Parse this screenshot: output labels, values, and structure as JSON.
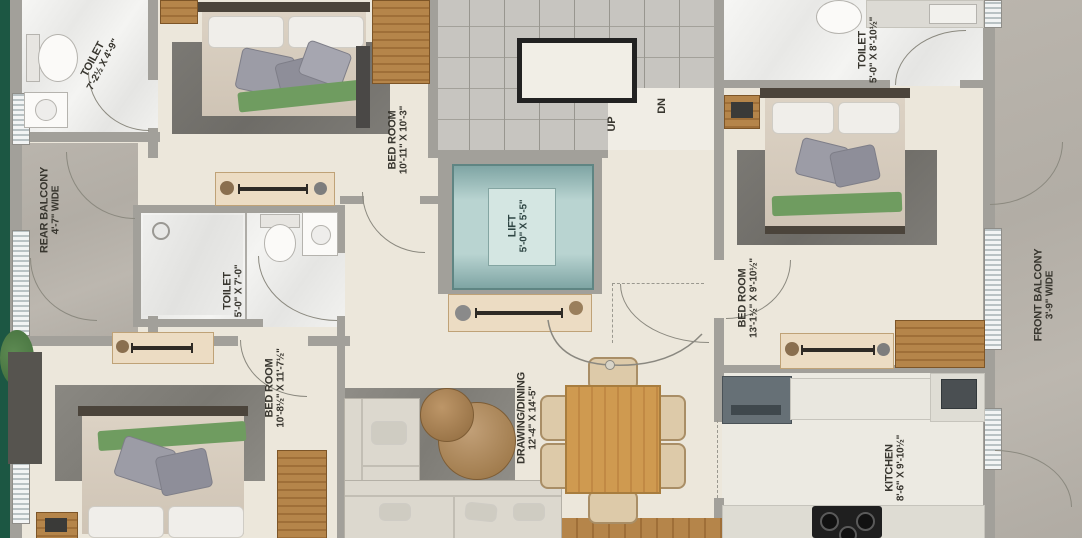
{
  "rooms": {
    "toilet_tl": {
      "name": "TOILET",
      "dims": "7'-2½ X 4'-9\""
    },
    "rear_balcony": {
      "name": "REAR BALCONY",
      "dims": "4'-7\" WIDE"
    },
    "bedroom_top": {
      "name": "BED ROOM",
      "dims": "10'-11\" X 10'-3\""
    },
    "lift": {
      "name": "LIFT",
      "dims": "5'-0\" X 5'-5\""
    },
    "toilet_mid": {
      "name": "TOILET",
      "dims": "5'-0\" X 7'-0\""
    },
    "bedroom_left": {
      "name": "BED ROOM",
      "dims": "10'-8½\" X 11'-7½\""
    },
    "drawing_dining": {
      "name": "DRAWING/DINING",
      "dims": "12'-4\" X 14'-5\""
    },
    "bedroom_right": {
      "name": "BED ROOM",
      "dims": "13'-1½\" X 9'-10½\""
    },
    "toilet_tr": {
      "name": "TOILET",
      "dims": "5'-0\" X 8'-10½\""
    },
    "front_balcony": {
      "name": "FRONT BALCONY",
      "dims": "3'-9\" WIDE"
    },
    "kitchen": {
      "name": "KITCHEN",
      "dims": "8'-6\" X 9'-10½\""
    },
    "stairs": {
      "up": "UP",
      "dn": "DN"
    }
  },
  "colors": {
    "floor_cream": "#ece7db",
    "wall_gray": "#a2a09a",
    "balcony_concrete": "#b7b2aa",
    "lift_teal": "#b7d3d0",
    "wood": "#b5854a",
    "edge_green": "#1c5743",
    "label_text": "#38362f"
  }
}
